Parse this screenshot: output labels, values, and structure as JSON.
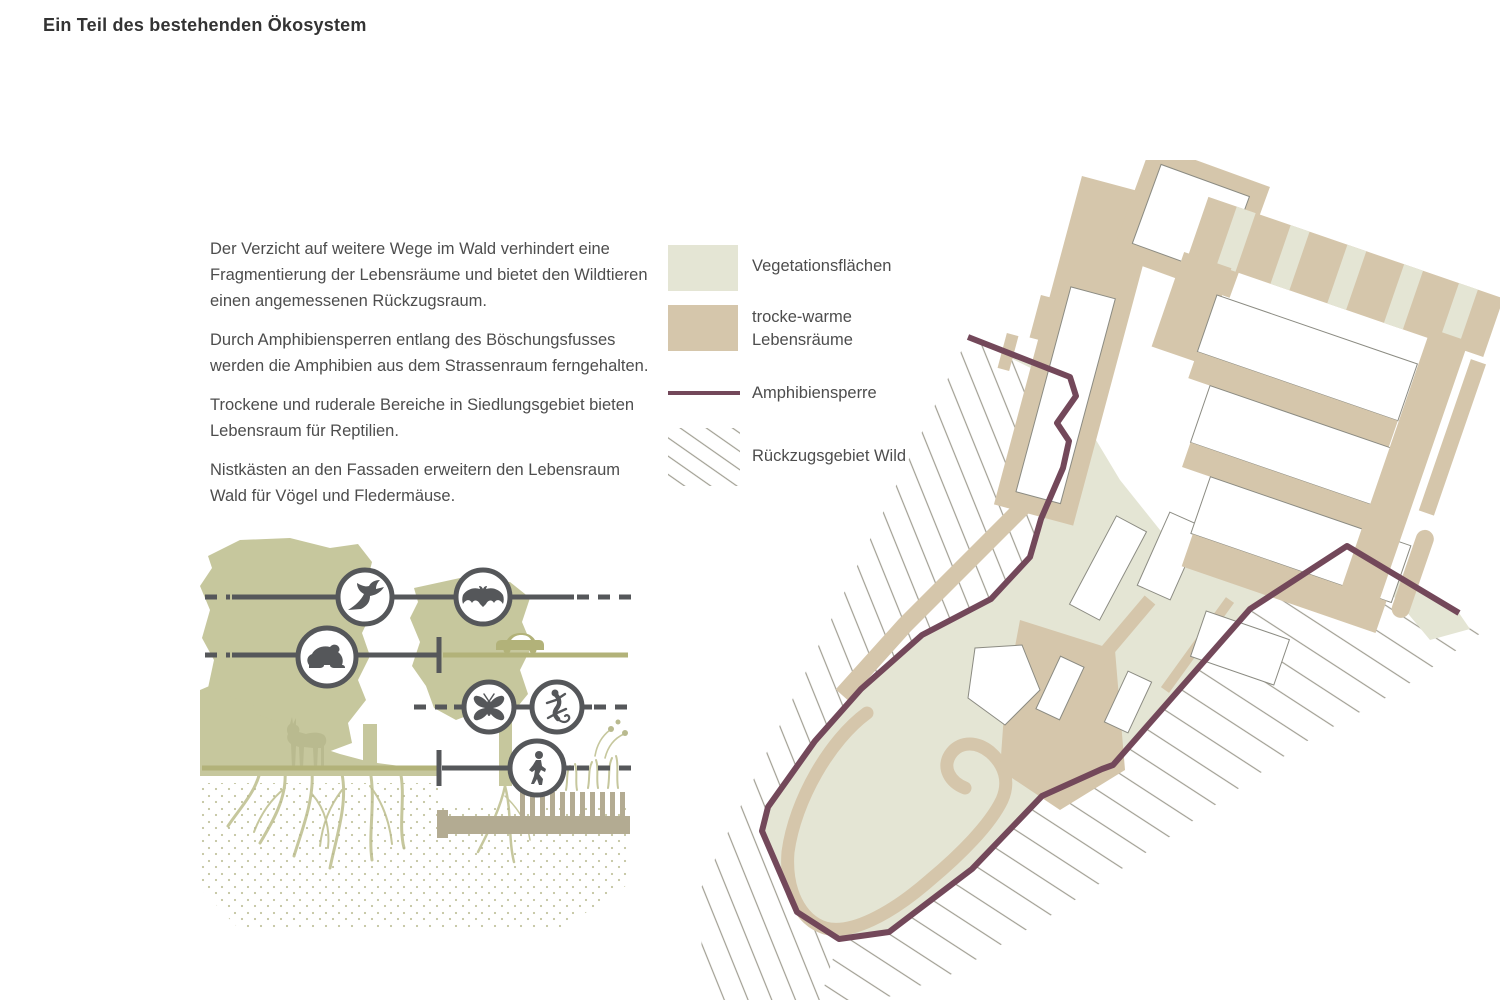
{
  "title": "Ein Teil des bestehenden Ökosystem",
  "intro": {
    "paragraphs": [
      "Der Verzicht auf weitere Wege im Wald verhindert eine Fragmentierung der Lebensräume und bietet den Wildtieren einen angemessenen Rückzugsraum.",
      "Durch Amphibiensperren entlang des Böschungsfusses werden die Amphibien aus dem Strassenraum ferngehalten.",
      "Trockene und ruderale Bereiche in Siedlungsgebiet bieten Lebensraum für Reptilien.",
      "Nistkästen an den Fassaden erweitern den Lebensraum Wald für Vögel und Fledermäuse."
    ]
  },
  "legend": {
    "items": [
      {
        "label": "Vegetationsflächen",
        "swatch": "filled-square",
        "color": "#e4e5d4"
      },
      {
        "label": "trocke-warme Lebensräume",
        "swatch": "filled-square",
        "color": "#d5c6ab"
      },
      {
        "label": "Amphibiensperre",
        "swatch": "line",
        "color": "#73485a"
      },
      {
        "label": "Rückzugsgebiet Wild",
        "swatch": "diagonal-hatch",
        "color": "#a19f93"
      }
    ]
  },
  "illustration": {
    "icons": [
      "bird",
      "bat",
      "frog",
      "moth",
      "lizard",
      "pedestrian",
      "car",
      "deer"
    ],
    "corridor_rows": 4
  },
  "colors": {
    "background": "#ffffff",
    "heading": "#333333",
    "text": "#4d4d4d",
    "vegetation": "#e4e5d4",
    "warm_habitat": "#d5c6ab",
    "wall_tan": "#b3ab92",
    "amphibian_barrier": "#73485a",
    "hatch_line": "#a19f93",
    "building_outline": "#8b8b82",
    "corridor_dark": "#55575a",
    "corridor_olive": "#b2b279",
    "illustration_olive": "#c6c79d",
    "illustration_olive_dark": "#b9ba8f"
  }
}
